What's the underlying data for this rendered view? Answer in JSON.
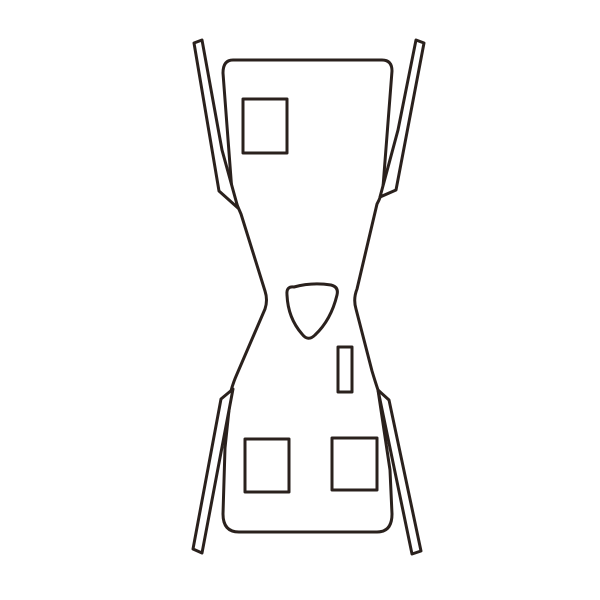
{
  "canvas": {
    "width": 600,
    "height": 600,
    "background_color": "#ffffff"
  },
  "illustration": {
    "title": "apron-line-drawing",
    "stroke_color": "#2a211d",
    "fill_color": "#ffffff",
    "stroke_width": 3,
    "shapes": [
      {
        "name": "apron-body-outline",
        "d": "M 233,60 L 382,60 Q 392,60 392,71 L 383,187 Q 381,197 377,204 L 357,289 Q 353,299 356,309 L 372,371 Q 375,381 378,390 L 390,470 L 392,514 Q 392,532 377,532 L 239,532 Q 223,532 223,514 L 225,448 L 231,391 Q 233,383 237,374 L 265,309 Q 268,300 265,291 L 241,214 Q 236,203 232,192 L 223,73 Q 223,60 233,60 Z"
      },
      {
        "name": "shoulder-strap-left",
        "d": "M 194,43 L 202,40 L 222,150 L 238,208 L 219,191 Z"
      },
      {
        "name": "shoulder-strap-right",
        "d": "M 424,43 L 416,40 L 398,130 L 380,197 L 396,190 Z"
      },
      {
        "name": "waist-tie-left",
        "d": "M 233,389 L 221,399 L 193,549 L 202,553 Z"
      },
      {
        "name": "waist-tie-right",
        "d": "M 378,390 L 389,400 L 421,551 L 412,554 Z"
      },
      {
        "name": "chest-pocket",
        "d": "M 243,99 L 287,99 L 287,153 L 243,153 Z"
      },
      {
        "name": "lower-pocket-left",
        "d": "M 245,439 L 289,439 L 289,492 L 245,492 Z"
      },
      {
        "name": "lower-pocket-right",
        "d": "M 332,438 L 377,438 L 377,490 L 332,490 Z"
      },
      {
        "name": "loop-slit",
        "d": "M 338,347 L 352,347 L 352,392 L 338,392 Z"
      },
      {
        "name": "neck-accent-triangle",
        "d": "M 294,287 Q 312,282 331,285 Q 339,287 337,295 Q 331,320 315,335 Q 308,342 302,334 Q 288,318 287,295 Q 286,286 294,287 Z"
      }
    ]
  }
}
